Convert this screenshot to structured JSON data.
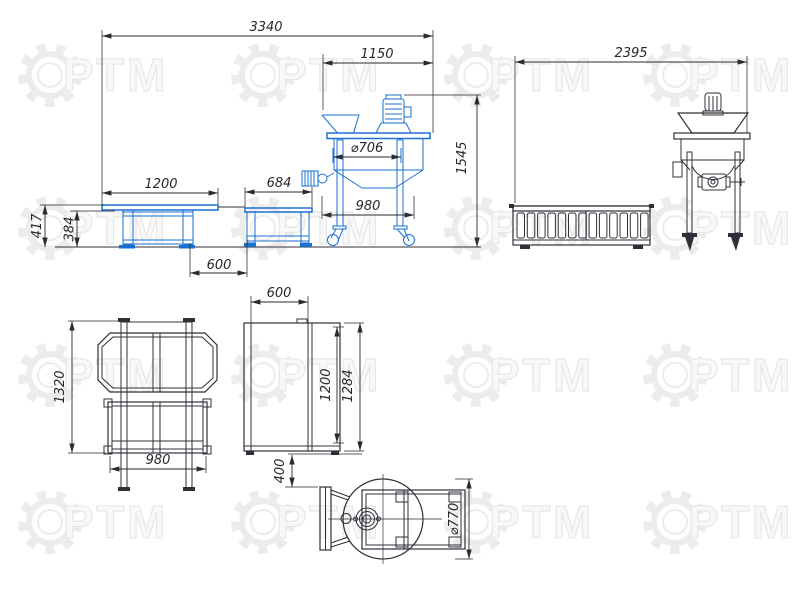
{
  "watermark": {
    "text": "РТМ"
  },
  "colors": {
    "blue_line": "#1a70d0",
    "dark_line": "#2f2f38",
    "dim_line": "#2a2a31",
    "watermark": "#ececec"
  },
  "views": {
    "side_elevation": {
      "label": "side-elevation-of-line",
      "dims": {
        "overall": "3340",
        "mixer_span": "1150",
        "mixer_height": "1545",
        "table1_length": "1200",
        "table2_length": "684",
        "tables_gap": "600",
        "conveyor_height": "417",
        "table_height": "384",
        "tank_diameter": "⌀706",
        "base_width": "980"
      }
    },
    "end_elevation": {
      "label": "end-elevation",
      "dims": {
        "overall": "2395"
      }
    },
    "plan_tables": {
      "label": "plan-of-tables",
      "dims": {
        "length": "1320",
        "width": "980"
      }
    },
    "plan_conveyor": {
      "label": "plan-of-conveyor",
      "dims": {
        "width": "600",
        "belt_length": "1200",
        "overall_length": "1284",
        "offset_to_mixer": "400"
      }
    },
    "plan_mixer": {
      "label": "plan-of-mixer",
      "dims": {
        "tank_diameter": "⌀770"
      }
    }
  }
}
